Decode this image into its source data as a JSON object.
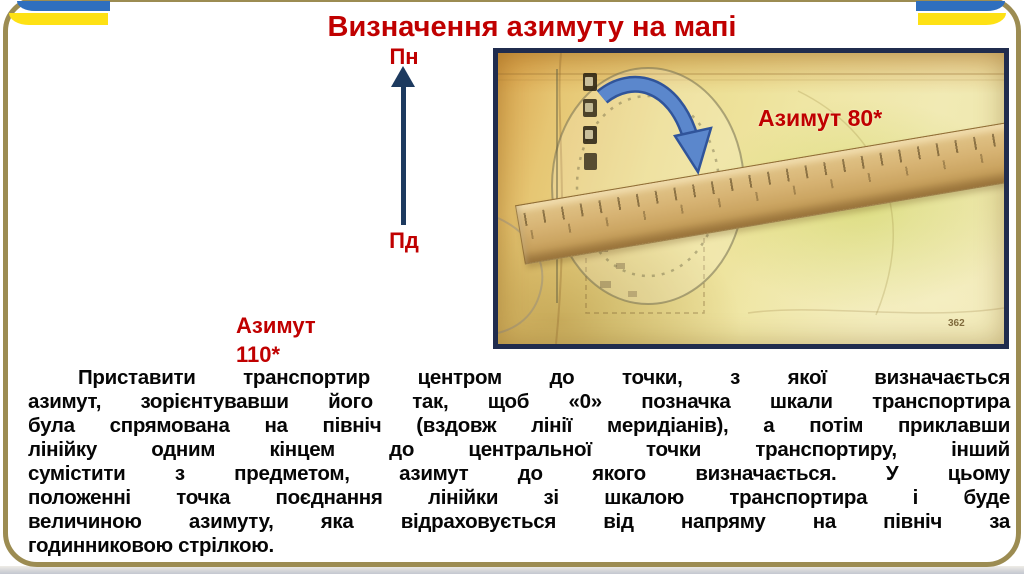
{
  "title": "Визначення азимуту на мапі",
  "compass": {
    "north": "Пн",
    "south": "Пд"
  },
  "azimuth_note": {
    "label": "Азимут",
    "value": "110*"
  },
  "photo": {
    "caption": "Азимут 80*",
    "map_mark": "362"
  },
  "paragraph": {
    "lines": [
      "Приставити транспортир центром до точки, з якої визначається",
      "азимут, зорієнтувавши його так, щоб «0» позначка шкали транспортира",
      "була спрямована на північ (вздовж лінії меридіанів), а потім приклавши",
      "лінійку одним кінцем до центральної точки транспортиру, інший",
      "сумістити з предметом, азимут до якого визначається. У цьому",
      "положенні точка поєднання лінійки зі шкалою транспортира і буде",
      "величиною азимуту, яка відраховується від напряму на північ за",
      "годинниковою стрілкою."
    ]
  },
  "colors": {
    "accent_red": "#C00000",
    "flag_blue": "#2F6FBE",
    "flag_yellow": "#FEE114",
    "frame_gold": "#9C8C52",
    "arrow_navy": "#1D3A5F",
    "photo_border_navy": "#202C4E",
    "curved_arrow_blue": "#5B87CC"
  },
  "icons": {
    "north_arrow": "↑",
    "curved_arrow": "⌒"
  }
}
